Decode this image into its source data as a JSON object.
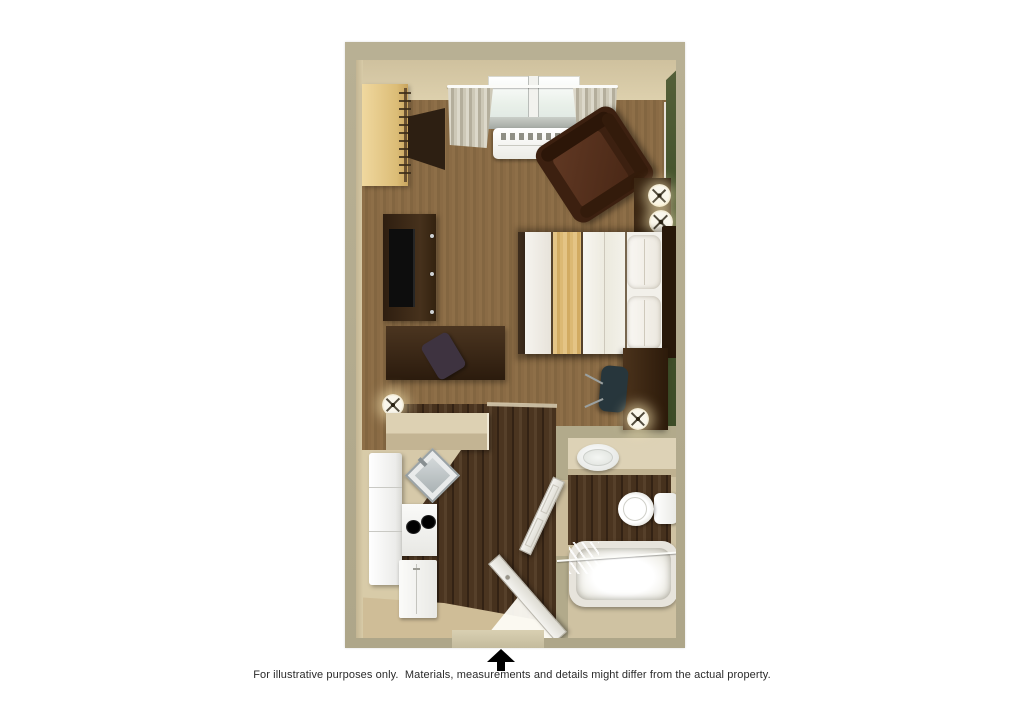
{
  "footer": {
    "entrance_icon": "entrance-arrow-icon",
    "disclaimer": "For illustrative purposes only.  Materials, measurements and details might differ from the actual property."
  },
  "floorplan": {
    "type": "studio-suite-floor-plan",
    "rooms": [
      {
        "name": "bedroom-living-area",
        "floor": "carpet"
      },
      {
        "name": "kitchen",
        "floor": "wood-plank"
      },
      {
        "name": "entry-hall",
        "floor": "wood-plank"
      },
      {
        "name": "bathroom",
        "floor": "tile"
      }
    ],
    "furniture": [
      "closet-with-hangers",
      "shelf",
      "tv-dresser",
      "television",
      "side-desk",
      "side-chair",
      "floor-lamp",
      "window",
      "curtains",
      "curtain-rod",
      "ac-unit",
      "armchair",
      "side-table",
      "table-lamp",
      "table-lamp",
      "queen-bed",
      "bed-scarf",
      "pillows",
      "headboard",
      "work-desk",
      "office-chair",
      "desk-lamp",
      "kitchen-counter",
      "kitchen-sink",
      "refrigerator",
      "stove",
      "dishwasher",
      "bathroom-vanity",
      "bathroom-sink",
      "toilet",
      "bathtub",
      "shower-curtain-rod",
      "bathroom-door",
      "entry-door"
    ],
    "palette": {
      "page_background": "#ffffff",
      "wall": "#b3ab8d",
      "interior_wall": "#d8cba8",
      "accent_wall_green": "#47552e",
      "carpet": "#8a6b45",
      "wood_floor": "#46311d",
      "counter": "#d8ccae",
      "bed_scarf_tan": "#dcbc7a",
      "dark_furniture": "#352414",
      "white_fixtures": "#f2f1ed",
      "arrow": "#000000",
      "disclaimer_text": "#2a2a2a"
    }
  }
}
